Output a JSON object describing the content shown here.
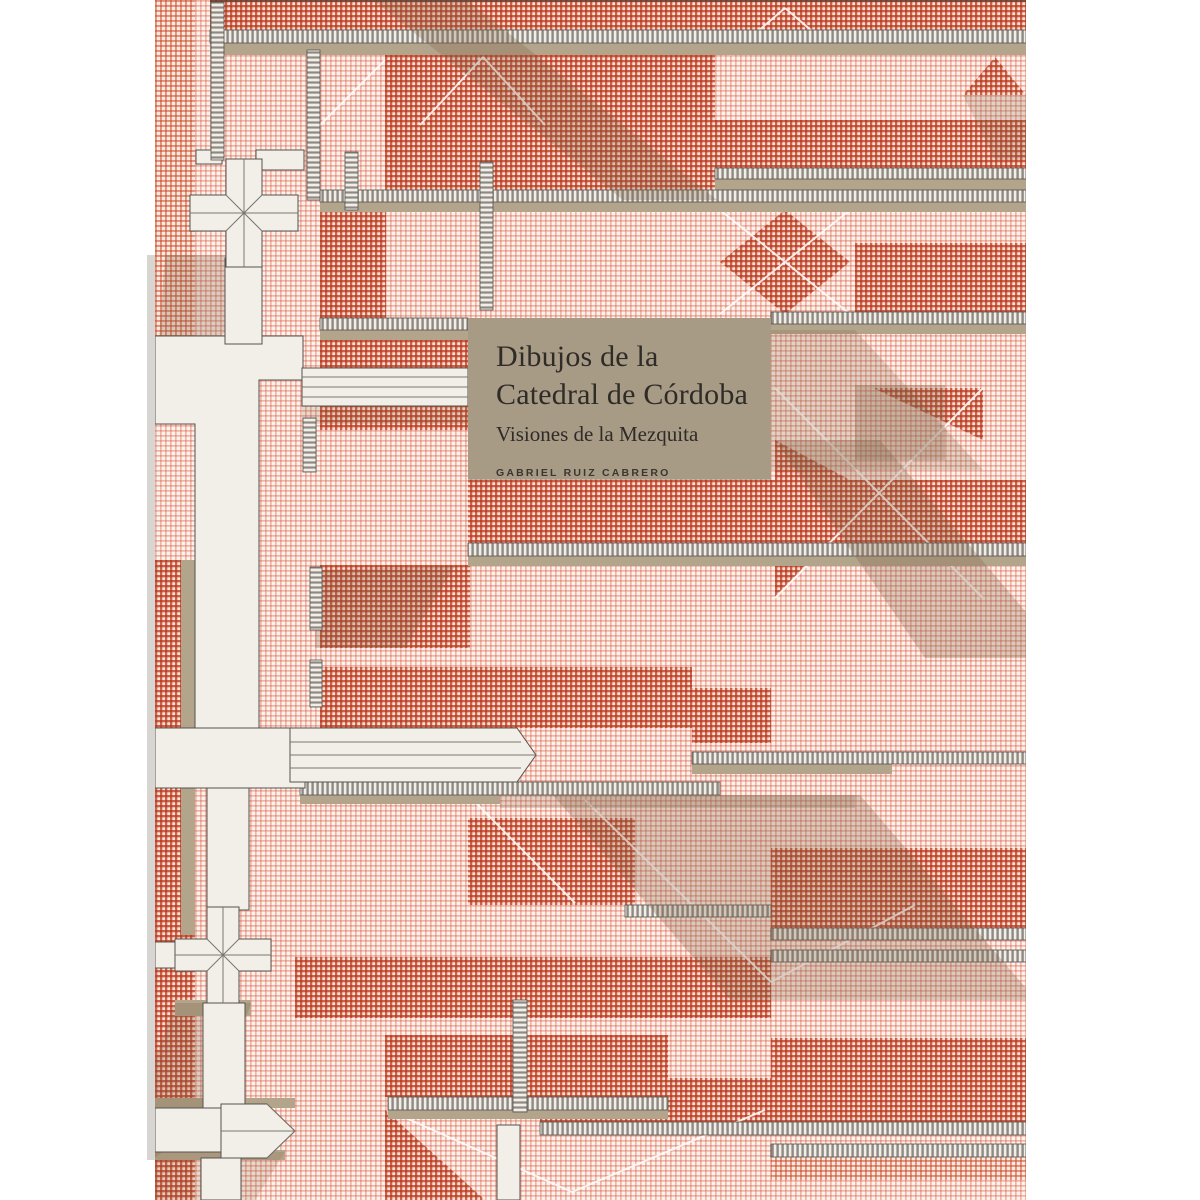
{
  "cover": {
    "title_line1": "Dibujos de la",
    "title_line2": "Catedral de Córdoba",
    "subtitle": "Visiones de la Mezquita",
    "author": "GABRIEL RUIZ CABRERO",
    "colors": {
      "label_box": "#a79b86",
      "roof_light": "#f3cfc8",
      "roof_dark": "#d97a63",
      "gap_tan": "#b3a48c",
      "structure_white": "#f2efe9",
      "shadow_brown": "#7d6245",
      "text": "#2f2b27",
      "page_background": "#ffffff"
    }
  }
}
